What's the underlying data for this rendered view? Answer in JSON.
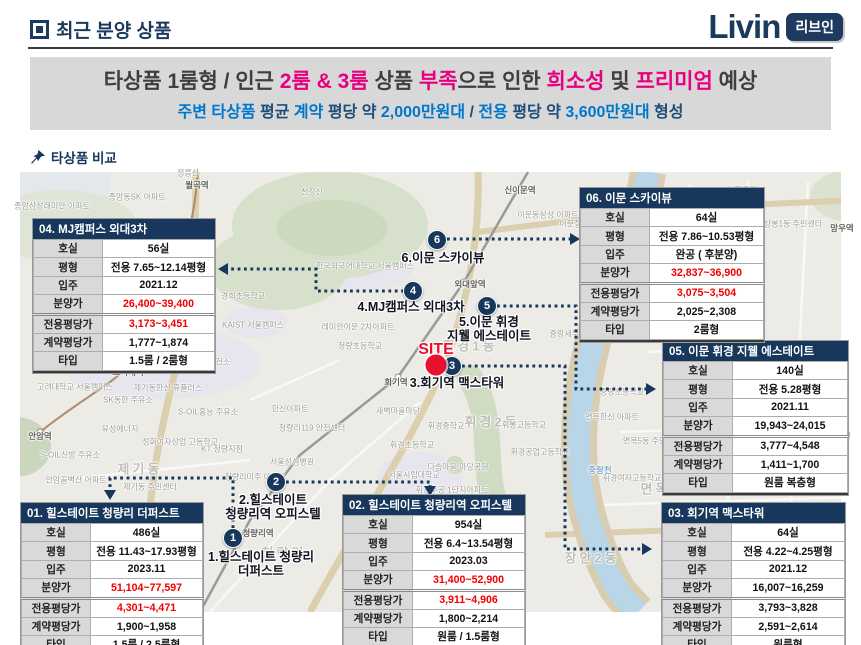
{
  "header": {
    "title": "최근 분양 상품",
    "brand": "Livin",
    "brand_badge": "리브인"
  },
  "banner": {
    "line1": [
      {
        "text": "타상품 1룸형 / 인근 ",
        "color": "dark"
      },
      {
        "text": "2룸 & 3룸",
        "color": "pink"
      },
      {
        "text": " 상품 ",
        "color": "dark"
      },
      {
        "text": "부족",
        "color": "pink"
      },
      {
        "text": "으로 인한 ",
        "color": "dark"
      },
      {
        "text": "희소성",
        "color": "pink"
      },
      {
        "text": " 및 ",
        "color": "dark"
      },
      {
        "text": "프리미엄",
        "color": "pink"
      },
      {
        "text": " 예상",
        "color": "dark"
      }
    ],
    "line2": [
      {
        "text": "주변 타상품 ",
        "color": "blue"
      },
      {
        "text": "평균 ",
        "color": "navy"
      },
      {
        "text": "계약",
        "color": "blue"
      },
      {
        "text": " 평당 약 ",
        "color": "navy"
      },
      {
        "text": "2,000만원대",
        "color": "blue"
      },
      {
        "text": " / ",
        "color": "navy"
      },
      {
        "text": "전용",
        "color": "blue"
      },
      {
        "text": " 평당 약 ",
        "color": "navy"
      },
      {
        "text": "3,600만원대",
        "color": "blue"
      },
      {
        "text": " 형성",
        "color": "navy"
      }
    ]
  },
  "section_label": "타상품 비교",
  "map": {
    "site": {
      "label": "SITE",
      "x": 436,
      "y": 365,
      "label_y": 341
    },
    "markers": [
      {
        "num": "1",
        "x": 233,
        "y": 538,
        "label_lines": "1.힐스테이트 청량리\n더퍼스트",
        "label_x": 261,
        "label_y": 550
      },
      {
        "num": "2",
        "x": 276,
        "y": 482,
        "label_lines": "2.힐스테이트\n청량리역 오피스텔",
        "label_x": 273,
        "label_y": 493
      },
      {
        "num": "3",
        "x": 452,
        "y": 366,
        "label_lines": "3.회기역 맥스타워",
        "label_x": 457,
        "label_y": 376
      },
      {
        "num": "4",
        "x": 413,
        "y": 291,
        "label_lines": "4.MJ캠퍼스 외대3차",
        "label_x": 411,
        "label_y": 300
      },
      {
        "num": "5",
        "x": 487,
        "y": 306,
        "label_lines": "5.이문 휘경\n지웰 에스테이트",
        "label_x": 489,
        "label_y": 315
      },
      {
        "num": "6",
        "x": 437,
        "y": 240,
        "label_lines": "6.이문 스카이뷰",
        "label_x": 443,
        "label_y": 251
      }
    ],
    "connectors": [
      {
        "points": [
          [
            447,
            239
          ],
          [
            572,
            239
          ]
        ],
        "tip": [
          580,
          239
        ],
        "dir": "right"
      },
      {
        "points": [
          [
            404,
            291
          ],
          [
            316,
            291
          ],
          [
            316,
            269
          ],
          [
            226,
            269
          ]
        ],
        "tip": [
          218,
          269
        ],
        "dir": "left"
      },
      {
        "points": [
          [
            497,
            306
          ],
          [
            576,
            306
          ],
          [
            576,
            389
          ],
          [
            648,
            389
          ]
        ],
        "tip": [
          656,
          389
        ],
        "dir": "right"
      },
      {
        "points": [
          [
            462,
            366
          ],
          [
            565,
            366
          ],
          [
            565,
            549
          ],
          [
            644,
            549
          ]
        ],
        "tip": [
          652,
          549
        ],
        "dir": "right"
      },
      {
        "points": [
          [
            286,
            482
          ],
          [
            430,
            482
          ],
          [
            430,
            486
          ]
        ],
        "tip": [
          430,
          496
        ],
        "dir": "down"
      },
      {
        "points": [
          [
            233,
            528
          ],
          [
            233,
            478
          ],
          [
            110,
            478
          ],
          [
            110,
            490
          ]
        ],
        "tip": [
          110,
          500
        ],
        "dir": "down"
      }
    ],
    "place_labels": [
      {
        "text": "종암삼성래미안 아파트",
        "x": 52,
        "y": 206,
        "type": "poi"
      },
      {
        "text": "종암동SK 아파트",
        "x": 137,
        "y": 197,
        "type": "poi"
      },
      {
        "text": "정릉선",
        "x": 188,
        "y": 173,
        "type": "poi"
      },
      {
        "text": "월곡역",
        "x": 197,
        "y": 185,
        "type": "station"
      },
      {
        "text": "천장산",
        "x": 312,
        "y": 192,
        "type": "poi"
      },
      {
        "text": "신이문역",
        "x": 520,
        "y": 190,
        "type": "station"
      },
      {
        "text": "이문동삼성 아파트",
        "x": 548,
        "y": 215,
        "type": "poi"
      },
      {
        "text": "이문철교",
        "x": 574,
        "y": 224,
        "type": "poi"
      },
      {
        "text": "중랑천",
        "x": 627,
        "y": 258,
        "type": "water"
      },
      {
        "text": "봉화공원",
        "x": 742,
        "y": 190,
        "type": "poi"
      },
      {
        "text": "상봉1동 주민센터",
        "x": 793,
        "y": 224,
        "type": "poi"
      },
      {
        "text": "망우역",
        "x": 842,
        "y": 228,
        "type": "station"
      },
      {
        "text": "상봉2동",
        "x": 722,
        "y": 306,
        "type": "area"
      },
      {
        "text": "중랑역",
        "x": 610,
        "y": 312,
        "type": "station"
      },
      {
        "text": "중랑세무서",
        "x": 568,
        "y": 334,
        "type": "poi"
      },
      {
        "text": "외대앞역",
        "x": 470,
        "y": 284,
        "type": "station"
      },
      {
        "text": "한국외국어대학교 서울캠퍼스",
        "x": 365,
        "y": 266,
        "type": "poi"
      },
      {
        "text": "경희초등학교",
        "x": 243,
        "y": 296,
        "type": "poi"
      },
      {
        "text": "KAIST 서울캠퍼스",
        "x": 253,
        "y": 325,
        "type": "poi"
      },
      {
        "text": "레미안이문 2차아파트",
        "x": 358,
        "y": 327,
        "type": "poi"
      },
      {
        "text": "청량초등학교",
        "x": 360,
        "y": 346,
        "type": "poi"
      },
      {
        "text": "회기역",
        "x": 396,
        "y": 382,
        "type": "station"
      },
      {
        "text": "휘경1동",
        "x": 470,
        "y": 345,
        "type": "area"
      },
      {
        "text": "고려대학교 서울캠퍼스",
        "x": 75,
        "y": 387,
        "type": "poi"
      },
      {
        "text": "고려대역",
        "x": 128,
        "y": 372,
        "type": "station"
      },
      {
        "text": "안암역",
        "x": 40,
        "y": 436,
        "type": "station"
      },
      {
        "text": "SK동한 주유소",
        "x": 128,
        "y": 400,
        "type": "poi"
      },
      {
        "text": "제기동한신 휴플러스",
        "x": 168,
        "y": 388,
        "type": "poi"
      },
      {
        "text": "SK-LPG 홍릉충전소",
        "x": 196,
        "y": 362,
        "type": "poi"
      },
      {
        "text": "S-OIL홍능 주유소",
        "x": 208,
        "y": 412,
        "type": "poi"
      },
      {
        "text": "유성에너지",
        "x": 120,
        "y": 429,
        "type": "poi"
      },
      {
        "text": "정화여자상업 고등학교",
        "x": 180,
        "y": 442,
        "type": "poi"
      },
      {
        "text": "KT 청량지점",
        "x": 222,
        "y": 449,
        "type": "poi"
      },
      {
        "text": "제기동",
        "x": 140,
        "y": 468,
        "type": "area"
      },
      {
        "text": "제기동 주민센터",
        "x": 150,
        "y": 487,
        "type": "poi"
      },
      {
        "text": "안암골벽산 아파트",
        "x": 76,
        "y": 480,
        "type": "poi"
      },
      {
        "text": "S-OIL신방 주유소",
        "x": 70,
        "y": 455,
        "type": "poi"
      },
      {
        "text": "한신아파트",
        "x": 290,
        "y": 409,
        "type": "poi"
      },
      {
        "text": "청량리119 안전센터",
        "x": 312,
        "y": 428,
        "type": "poi"
      },
      {
        "text": "청량리미주 아파트",
        "x": 255,
        "y": 477,
        "type": "poi"
      },
      {
        "text": "서울성심병원",
        "x": 292,
        "y": 462,
        "type": "poi"
      },
      {
        "text": "서울시립대학교",
        "x": 414,
        "y": 475,
        "type": "poi"
      },
      {
        "text": "새벽마을마당",
        "x": 398,
        "y": 411,
        "type": "poi"
      },
      {
        "text": "휘경중학교",
        "x": 446,
        "y": 426,
        "type": "poi"
      },
      {
        "text": "휘경초등학교",
        "x": 412,
        "y": 445,
        "type": "poi"
      },
      {
        "text": "휘경2동",
        "x": 492,
        "y": 421,
        "type": "area"
      },
      {
        "text": "휘봉고등학교",
        "x": 524,
        "y": 425,
        "type": "poi"
      },
      {
        "text": "휘경공업고등학교",
        "x": 540,
        "y": 452,
        "type": "poi"
      },
      {
        "text": "휘경여자고등학교",
        "x": 632,
        "y": 478,
        "type": "poi"
      },
      {
        "text": "다솜마을 마당공원",
        "x": 458,
        "y": 467,
        "type": "poi"
      },
      {
        "text": "휘경주공 1단지아파트",
        "x": 452,
        "y": 490,
        "type": "poi"
      },
      {
        "text": "청량리역",
        "x": 258,
        "y": 533,
        "type": "station"
      },
      {
        "text": "청량리",
        "x": 284,
        "y": 552,
        "type": "area"
      },
      {
        "text": "중랑초등학교",
        "x": 622,
        "y": 392,
        "type": "poi"
      },
      {
        "text": "면목한신 아파트",
        "x": 612,
        "y": 417,
        "type": "poi"
      },
      {
        "text": "면목5동 주민센터",
        "x": 652,
        "y": 441,
        "type": "poi"
      },
      {
        "text": "면동초등학교",
        "x": 752,
        "y": 440,
        "type": "poi"
      },
      {
        "text": "남촌공원",
        "x": 836,
        "y": 436,
        "type": "poi"
      },
      {
        "text": "까치공원",
        "x": 810,
        "y": 480,
        "type": "poi"
      },
      {
        "text": "면목5동",
        "x": 668,
        "y": 488,
        "type": "area"
      },
      {
        "text": "중랑천",
        "x": 600,
        "y": 470,
        "type": "water"
      },
      {
        "text": "장안2동",
        "x": 592,
        "y": 557,
        "type": "area"
      }
    ]
  },
  "tables": [
    {
      "id": "01",
      "title": "01. 힐스테이트 청량리 더퍼스트",
      "x": 21,
      "y": 503,
      "w": 182,
      "rows": [
        {
          "label": "호실",
          "value": "486실",
          "red": false
        },
        {
          "label": "평형",
          "value": "전용 11.43~17.93평형",
          "red": false
        },
        {
          "label": "입주",
          "value": "2023.11",
          "red": false
        },
        {
          "label": "분양가",
          "value": "51,104~77,597",
          "red": true
        },
        {
          "label": "전용평당가",
          "value": "4,301~4,471",
          "red": true
        },
        {
          "label": "계약평당가",
          "value": "1,900~1,958",
          "red": false
        },
        {
          "label": "타입",
          "value": "1.5룸 / 2.5룸형",
          "red": false
        }
      ]
    },
    {
      "id": "02",
      "title": "02. 힐스테이트 청량리역 오피스텔",
      "x": 343,
      "y": 495,
      "w": 182,
      "rows": [
        {
          "label": "호실",
          "value": "954실",
          "red": false
        },
        {
          "label": "평형",
          "value": "전용 6.4~13.54평형",
          "red": false
        },
        {
          "label": "입주",
          "value": "2023.03",
          "red": false
        },
        {
          "label": "분양가",
          "value": "31,400~52,900",
          "red": true
        },
        {
          "label": "전용평당가",
          "value": "3,911~4,906",
          "red": true
        },
        {
          "label": "계약평당가",
          "value": "1,800~2,214",
          "red": false
        },
        {
          "label": "타입",
          "value": "원룸 / 1.5룸형",
          "red": false
        }
      ]
    },
    {
      "id": "03",
      "title": "03. 회기역 맥스타워",
      "x": 662,
      "y": 503,
      "w": 183,
      "rows": [
        {
          "label": "호실",
          "value": "64실",
          "red": false
        },
        {
          "label": "평형",
          "value": "전용 4.22~4.25평형",
          "red": false
        },
        {
          "label": "입주",
          "value": "2021.12",
          "red": false
        },
        {
          "label": "분양가",
          "value": "16,007~16,259",
          "red": false
        },
        {
          "label": "전용평당가",
          "value": "3,793~3,828",
          "red": false
        },
        {
          "label": "계약평당가",
          "value": "2,591~2,614",
          "red": false
        },
        {
          "label": "타입",
          "value": "원룸형",
          "red": false
        }
      ]
    },
    {
      "id": "04",
      "title": "04. MJ캠퍼스 외대3차",
      "x": 33,
      "y": 219,
      "w": 182,
      "rows": [
        {
          "label": "호실",
          "value": "56실",
          "red": false
        },
        {
          "label": "평형",
          "value": "전용 7.65~12.14평형",
          "red": false
        },
        {
          "label": "입주",
          "value": "2021.12",
          "red": false
        },
        {
          "label": "분양가",
          "value": "26,400~39,400",
          "red": true
        },
        {
          "label": "전용평당가",
          "value": "3,173~3,451",
          "red": true
        },
        {
          "label": "계약평당가",
          "value": "1,777~1,874",
          "red": false
        },
        {
          "label": "타입",
          "value": "1.5룸 / 2룸형",
          "red": false
        }
      ]
    },
    {
      "id": "05",
      "title": "05. 이문 휘경 지웰 에스테이트",
      "x": 663,
      "y": 341,
      "w": 185,
      "rows": [
        {
          "label": "호실",
          "value": "140실",
          "red": false
        },
        {
          "label": "평형",
          "value": "전용 5.28평형",
          "red": false
        },
        {
          "label": "입주",
          "value": "2021.11",
          "red": false
        },
        {
          "label": "분양가",
          "value": "19,943~24,015",
          "red": false
        },
        {
          "label": "전용평당가",
          "value": "3,777~4,548",
          "red": false
        },
        {
          "label": "계약평당가",
          "value": "1,411~1,700",
          "red": false
        },
        {
          "label": "타입",
          "value": "원룸 복층형",
          "red": false
        }
      ]
    },
    {
      "id": "06",
      "title": "06. 이문 스카이뷰",
      "x": 580,
      "y": 188,
      "w": 184,
      "rows": [
        {
          "label": "호실",
          "value": "64실",
          "red": false
        },
        {
          "label": "평형",
          "value": "전용 7.86~10.53평형",
          "red": false
        },
        {
          "label": "입주",
          "value": "완공 ( 후분양)",
          "red": false
        },
        {
          "label": "분양가",
          "value": "32,837~36,900",
          "red": true
        },
        {
          "label": "전용평당가",
          "value": "3,075~3,504",
          "red": true
        },
        {
          "label": "계약평당가",
          "value": "2,025~2,308",
          "red": false
        },
        {
          "label": "타입",
          "value": "2룸형",
          "red": false
        }
      ]
    }
  ],
  "footer": {
    "company_parts": [
      {
        "text": "엘",
        "color": "gray"
      },
      {
        "text": "&",
        "color": "orange"
      },
      {
        "text": "피파트너",
        "color": "gray"
      }
    ],
    "page": "13"
  }
}
